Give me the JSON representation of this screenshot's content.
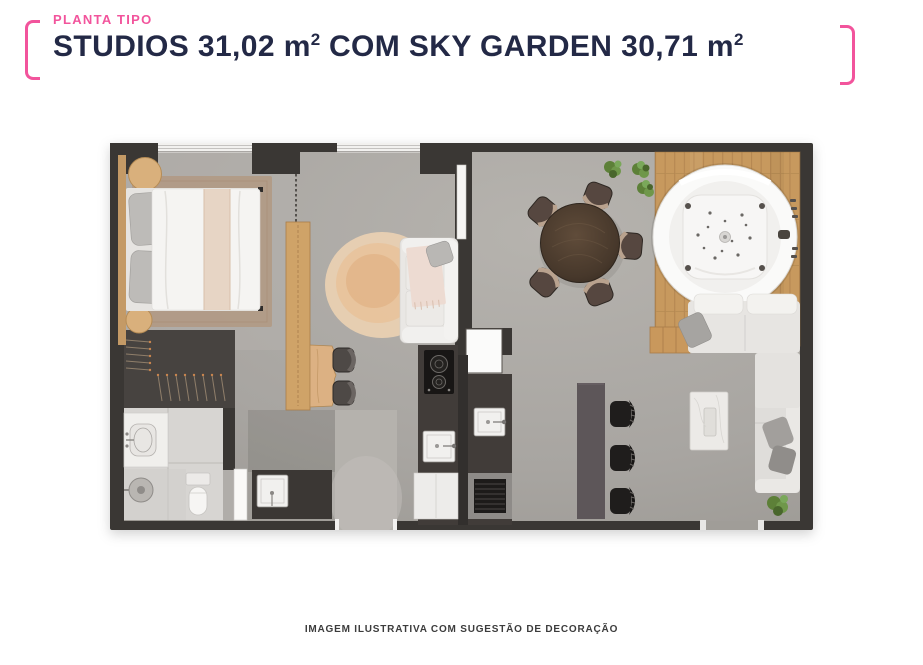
{
  "colors": {
    "accent": "#F2549C",
    "navy": "#232946",
    "caption": "#3C3C3C",
    "wall": "#3A3734",
    "floor": "#A8A5A1",
    "tile": "#D7D5D2",
    "deck": "#C7995E",
    "wood": "#CFA368",
    "counter": "#413C39",
    "bar": "#5D5659",
    "sofa": "#E7E5E2",
    "plant": "#6F974A"
  },
  "header": {
    "eyebrow": "PLANTA TIPO",
    "title_full": "STUDIOS 31,02 m² COM SKY GARDEN 30,71 m²",
    "title_parts": [
      "STUDIOS 31,02 m",
      "2",
      " COM SKY GARDEN 30,71 m",
      "2"
    ]
  },
  "floor_plan": {
    "caption": "IMAGEM ILUSTRATIVA COM SUGESTÃO DE DECORAÇÃO",
    "areas": [
      "bedroom",
      "bathroom",
      "wardrobe",
      "entry",
      "kitchen",
      "living-dining",
      "sky-garden-deck"
    ],
    "furniture": [
      "double-bed",
      "nightstands",
      "bedroom-rug",
      "sliding-door",
      "wood-shelf-divider",
      "desk-with-chairs",
      "loveseat",
      "round-rug",
      "vanity-sink",
      "shower",
      "toilet",
      "laundry-tank",
      "cooktop",
      "kitchen-sinks",
      "oven",
      "dining-table-5-chairs",
      "plants",
      "round-jacuzzi",
      "garden-sofa",
      "sectional-sofa",
      "coffee-table",
      "bar-counter-3-stools"
    ]
  }
}
